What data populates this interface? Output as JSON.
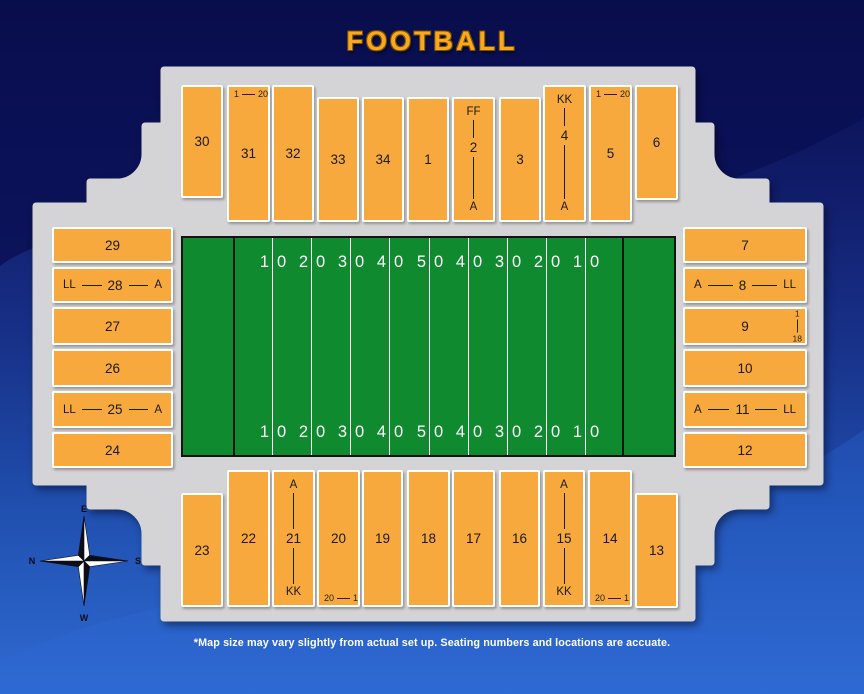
{
  "title": "FOOTBALL",
  "footer_note": "*Map size may vary slightly from actual set up. Seating numbers and locations are accuate.",
  "colors": {
    "section_fill": "#F7A93E",
    "concourse_gray": "#D4D4D6",
    "field_green": "#0F8A2E",
    "title_gold": "#F9A91F",
    "background_blue_dark": "#0A1050",
    "background_blue_light": "#2F6AD2"
  },
  "compass": {
    "top": "E",
    "right": "S",
    "bottom": "W",
    "left": "N"
  },
  "field": {
    "yard_numbers_top": [
      "10",
      "20",
      "30",
      "40",
      "50",
      "40",
      "30",
      "20",
      "10"
    ],
    "yard_numbers_bottom": [
      "10",
      "20",
      "30",
      "40",
      "50",
      "40",
      "30",
      "20",
      "10"
    ]
  },
  "stands": {
    "top": [
      {
        "label": "30"
      },
      {
        "label": "31",
        "range_from": "1",
        "range_to": "20"
      },
      {
        "label": "32"
      },
      {
        "label": "33"
      },
      {
        "label": "34"
      },
      {
        "label": "1"
      },
      {
        "label": "2",
        "top_label": "FF",
        "bottom_label": "A"
      },
      {
        "label": "3"
      },
      {
        "label": "4",
        "top_label": "KK",
        "bottom_label": "A"
      },
      {
        "label": "5",
        "range_from": "1",
        "range_to": "20"
      },
      {
        "label": "6"
      }
    ],
    "left": [
      {
        "label": "29"
      },
      {
        "label": "28",
        "left_label": "LL",
        "right_label": "A"
      },
      {
        "label": "27"
      },
      {
        "label": "26"
      },
      {
        "label": "25",
        "left_label": "LL",
        "right_label": "A"
      },
      {
        "label": "24"
      }
    ],
    "right": [
      {
        "label": "7"
      },
      {
        "label": "8",
        "left_label": "A",
        "right_label": "LL"
      },
      {
        "label": "9",
        "seat_range_top": "1",
        "seat_range_bottom": "18"
      },
      {
        "label": "10"
      },
      {
        "label": "11",
        "left_label": "A",
        "right_label": "LL"
      },
      {
        "label": "12"
      }
    ],
    "bottom": [
      {
        "label": "23"
      },
      {
        "label": "22"
      },
      {
        "label": "21",
        "top_label": "A",
        "bottom_label": "KK"
      },
      {
        "label": "20",
        "range_from": "20",
        "range_to": "1"
      },
      {
        "label": "19"
      },
      {
        "label": "18"
      },
      {
        "label": "17"
      },
      {
        "label": "16"
      },
      {
        "label": "15",
        "top_label": "A",
        "bottom_label": "KK"
      },
      {
        "label": "14",
        "range_from": "20",
        "range_to": "1"
      },
      {
        "label": "13"
      }
    ]
  }
}
